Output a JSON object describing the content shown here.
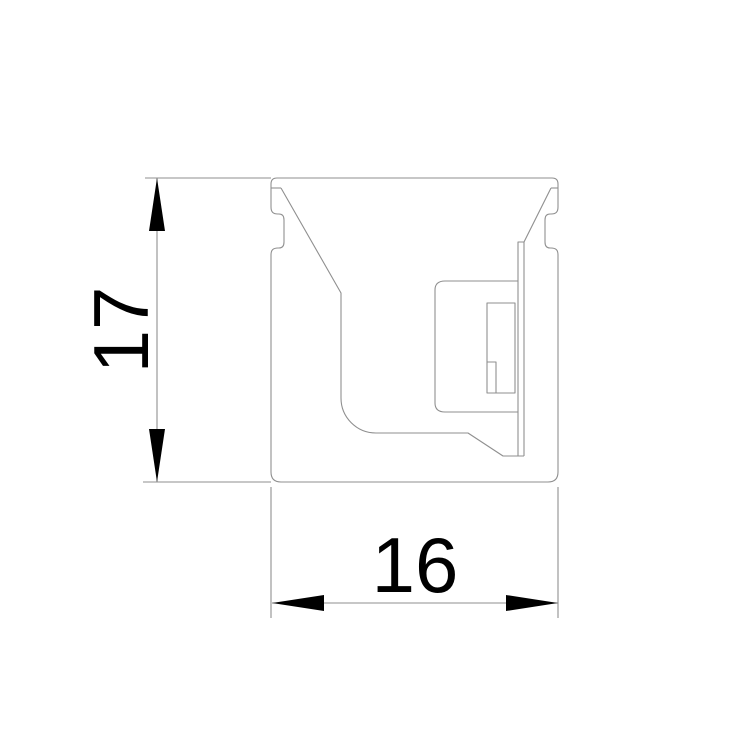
{
  "drawing": {
    "type": "technical-cross-section",
    "height_dimension": {
      "label": "17"
    },
    "width_dimension": {
      "label": "16"
    }
  },
  "colors": {
    "background": "#ffffff",
    "outline": "#8f8f8f",
    "annotation": "#000000"
  }
}
